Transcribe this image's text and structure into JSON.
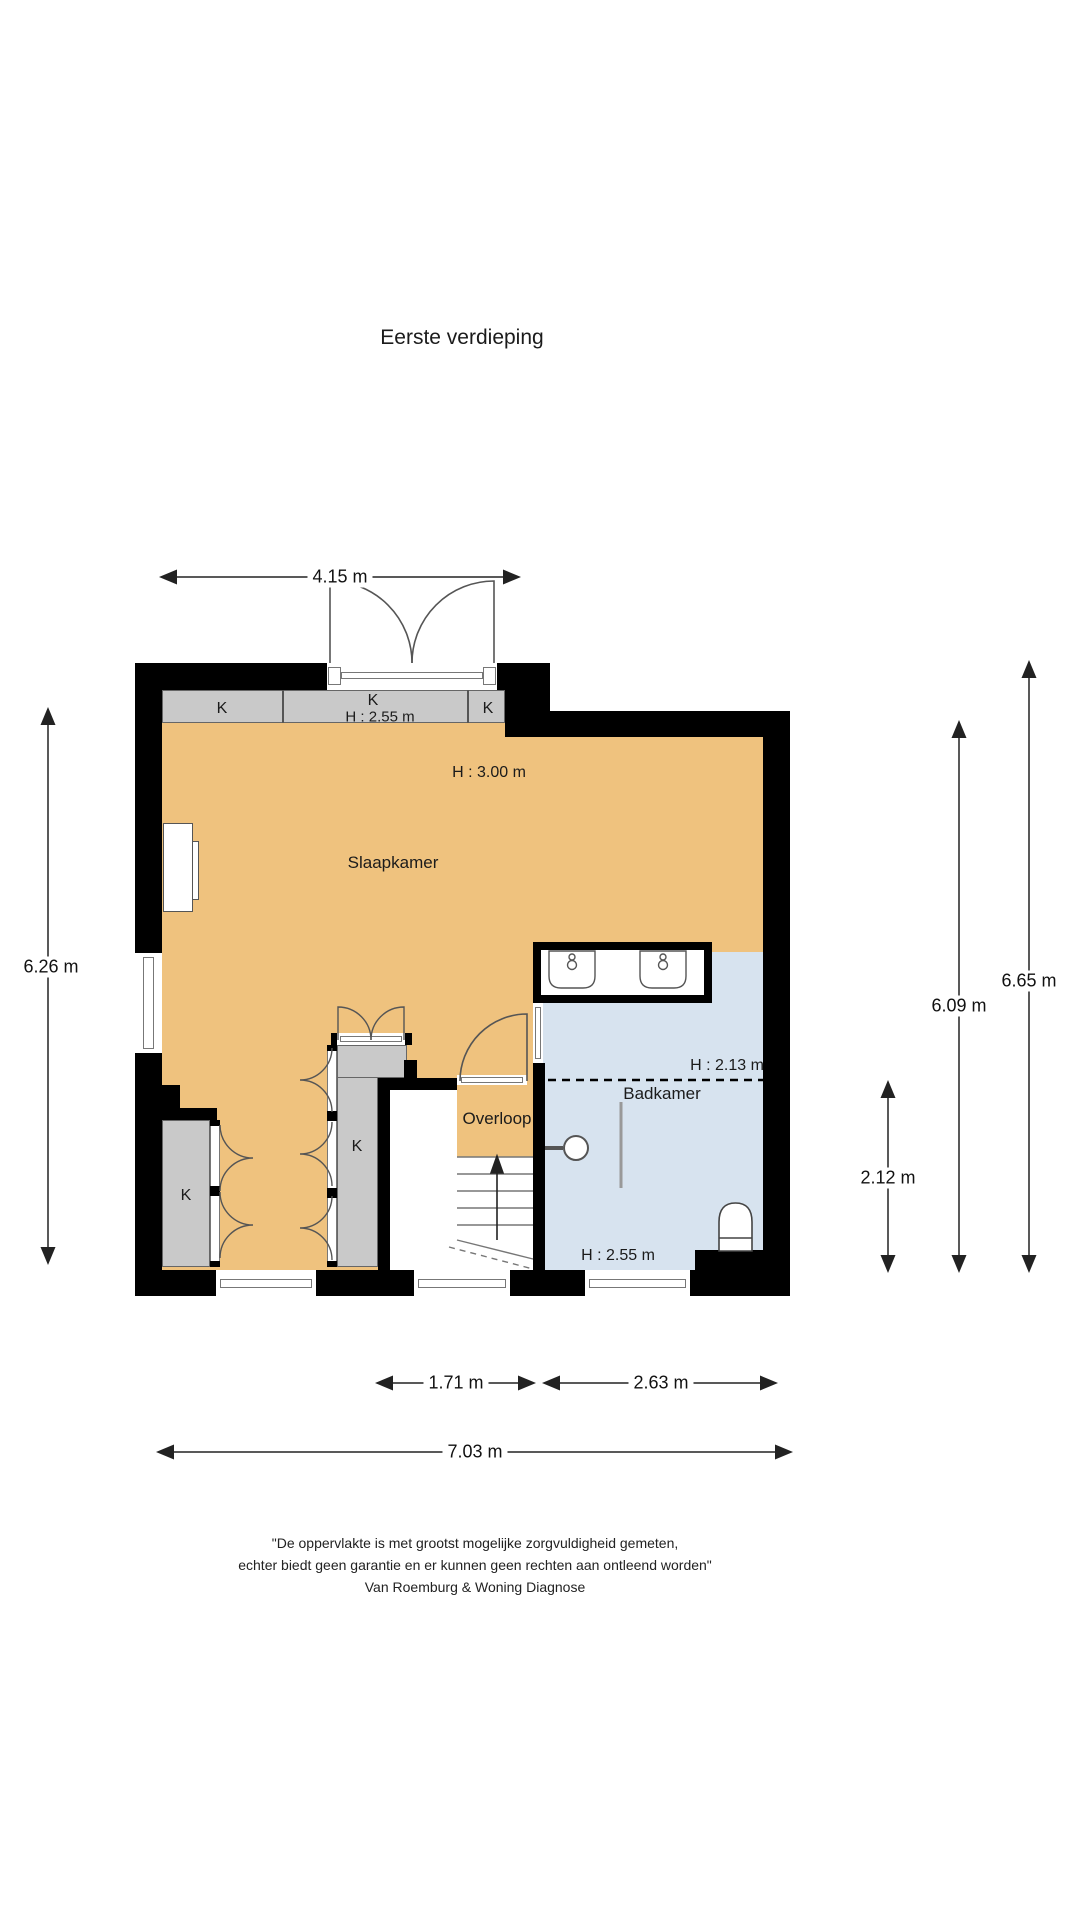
{
  "title": "Eerste verdieping",
  "rooms": {
    "slaapkamer": {
      "label": "Slaapkamer",
      "height_label": "H : 3.00 m"
    },
    "badkamer": {
      "label": "Badkamer",
      "height_upper": "H : 2.13 m",
      "height_lower": "H : 2.55 m"
    },
    "overloop": {
      "label": "Overloop"
    },
    "closets": {
      "top_left": "K",
      "top_mid": "K",
      "top_mid_height": "H : 2.55 m",
      "top_right": "K",
      "left": "K",
      "mid": "K"
    }
  },
  "dimensions": {
    "top_width": "4.15 m",
    "left_height": "6.26 m",
    "right_outer_height": "6.65 m",
    "right_inner_height": "6.09 m",
    "badkamer_height": "2.12 m",
    "stair_width": "1.71 m",
    "badkamer_width": "2.63 m",
    "total_width": "7.03 m"
  },
  "footer": {
    "line1": "\"De oppervlakte is met grootst mogelijke zorgvuldigheid gemeten,",
    "line2": "echter biedt geen garantie en er kunnen geen rechten aan ontleend worden\"",
    "line3": "Van Roemburg & Woning Diagnose"
  },
  "colors": {
    "floor_orange": "#EFC27E",
    "floor_blue": "#D7E3EF",
    "closet_gray": "#C9C9C9",
    "wall_black": "#000000",
    "line_dark": "#222222"
  }
}
